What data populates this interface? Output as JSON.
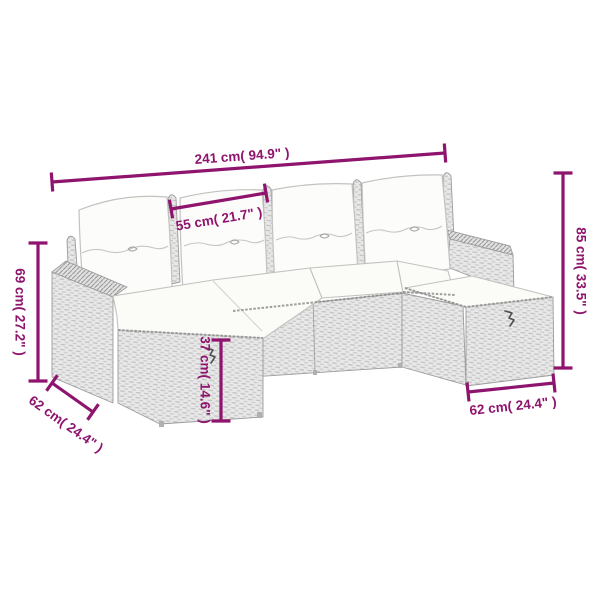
{
  "figure": {
    "type": "product-dimension-diagram",
    "subject": "rattan-garden-sofa-set-with-cushions",
    "background": "#ffffff"
  },
  "colors": {
    "accent": "#8F146E",
    "rattan_fill": "#e8e8e8",
    "rattan_weave": "#c2c2c2",
    "outline": "#9b9b9b",
    "cushion_fill": "#fbfbf8",
    "cushion_outline": "#c2c2bf",
    "hatch_line": "#989898",
    "bracket": "#4f4f4f"
  },
  "dimensions": [
    {
      "id": "total-width",
      "label": "241 cm( 94.9\" )",
      "cm": 241,
      "inches": 94.9,
      "line": {
        "x1": 52,
        "y1": 182,
        "x2": 445,
        "y2": 153
      },
      "label_pos": {
        "x": 242,
        "y": 156,
        "rotate": -4.2
      }
    },
    {
      "id": "seat-width",
      "label": "55 cm( 21.7\" )",
      "cm": 55,
      "inches": 21.7,
      "line": {
        "x1": 171,
        "y1": 209,
        "x2": 266,
        "y2": 193
      },
      "label_pos": {
        "x": 219,
        "y": 219,
        "rotate": -9.5
      }
    },
    {
      "id": "side-height",
      "label": "69 cm( 27.2\" )",
      "cm": 69,
      "inches": 27.2,
      "line": {
        "x1": 38,
        "y1": 243,
        "x2": 38,
        "y2": 381
      },
      "label_pos": {
        "x": 20,
        "y": 312,
        "rotate": 90
      }
    },
    {
      "id": "depth-left",
      "label": "62 cm( 24.4\" )",
      "cm": 62,
      "inches": 24.4,
      "line": {
        "x1": 52,
        "y1": 383,
        "x2": 93,
        "y2": 412
      },
      "label_pos": {
        "x": 66,
        "y": 424,
        "rotate": 35.3
      }
    },
    {
      "id": "seat-height",
      "label": "37 cm( 14.6\" )",
      "cm": 37,
      "inches": 14.6,
      "line": {
        "x1": 221,
        "y1": 340,
        "x2": 221,
        "y2": 421
      },
      "label_pos": {
        "x": 205,
        "y": 380,
        "rotate": 90
      }
    },
    {
      "id": "back-height",
      "label": "85 cm( 33.5\" )",
      "cm": 85,
      "inches": 33.5,
      "line": {
        "x1": 563,
        "y1": 173,
        "x2": 563,
        "y2": 368
      },
      "label_pos": {
        "x": 581,
        "y": 271,
        "rotate": 90
      }
    },
    {
      "id": "depth-right",
      "label": "62 cm( 24.4\" )",
      "cm": 62,
      "inches": 24.4,
      "line": {
        "x1": 468,
        "y1": 392,
        "x2": 554,
        "y2": 383
      },
      "label_pos": {
        "x": 513,
        "y": 406,
        "rotate": -6
      }
    }
  ]
}
